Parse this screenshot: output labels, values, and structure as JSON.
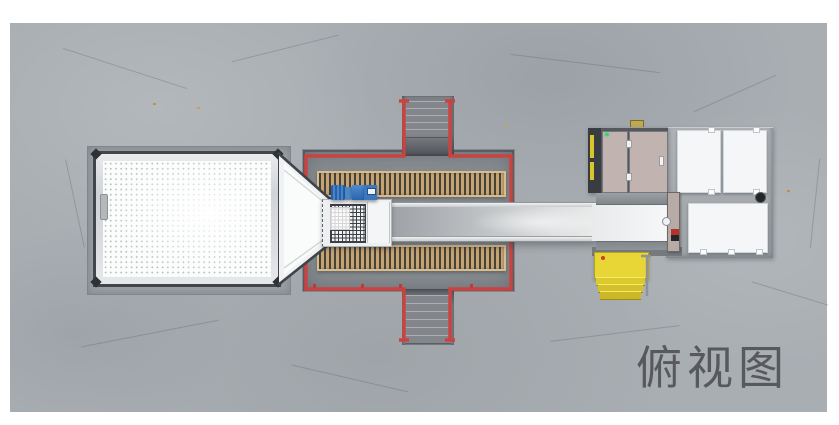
{
  "view_label": "俯视图",
  "colors": {
    "floor_gray": "#a9aeb3",
    "pit_gray": "#84898e",
    "railing_red": "#cb4340",
    "grating_wood": "#c6a373",
    "grating_slat": "#454238",
    "motor_blue": "#3a7bc0",
    "hopper_frame_dark": "#42464c",
    "hopper_white": "#fbfcfc",
    "belt_gray": "#b4b7ba",
    "machine_deck_gray": "#a4a9ae",
    "machine_panel_tan": "#c1b4b0",
    "access_panel_white": "#f5f6f7",
    "stair_yellow": "#e8d636",
    "indicator_green": "#35d473",
    "label_gray": "#58595c"
  }
}
